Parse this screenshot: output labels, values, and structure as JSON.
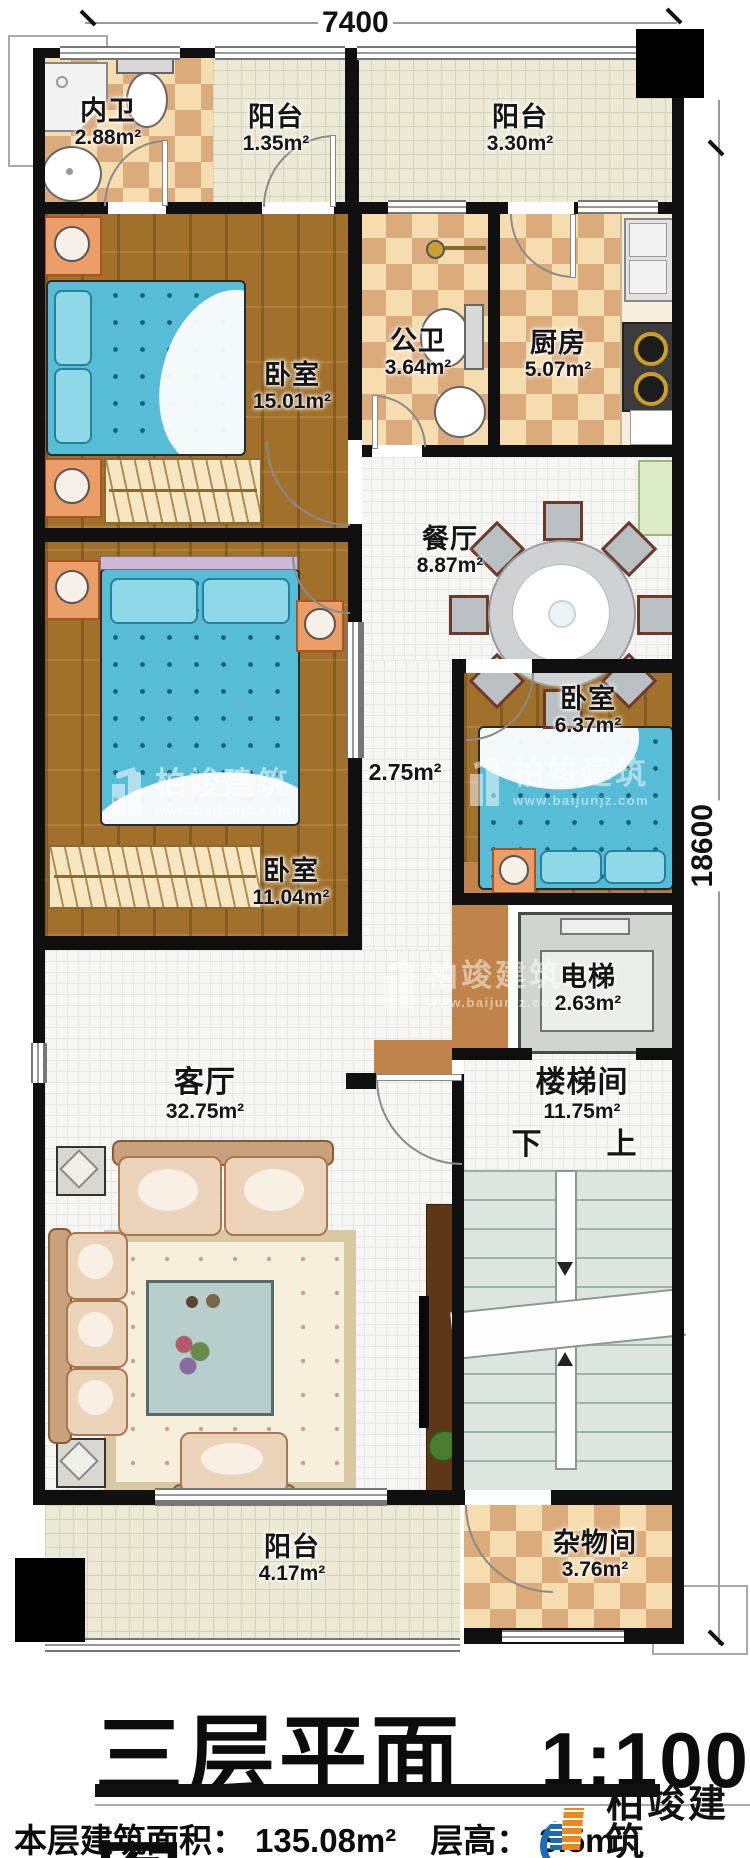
{
  "dimensions": {
    "width_mm": "7400",
    "height_mm": "18600"
  },
  "rooms": {
    "neiwei": {
      "name": "内卫",
      "area": "2.88m²"
    },
    "balcony_nw": {
      "name": "阳台",
      "area": "1.35m²"
    },
    "balcony_ne": {
      "name": "阳台",
      "area": "3.30m²"
    },
    "bedroom_nw": {
      "name": "卧室",
      "area": "15.01m²"
    },
    "gongwei": {
      "name": "公卫",
      "area": "3.64m²"
    },
    "kitchen": {
      "name": "厨房",
      "area": "5.07m²"
    },
    "dining": {
      "name": "餐厅",
      "area": "8.87m²"
    },
    "bedroom_e": {
      "name": "卧室",
      "area": "6.37m²"
    },
    "bedroom_w": {
      "name": "卧室",
      "area": "11.04m²"
    },
    "hall": {
      "area": "2.75m²"
    },
    "elevator": {
      "name": "电梯",
      "area": "2.63m²"
    },
    "living": {
      "name": "客厅",
      "area": "32.75m²"
    },
    "stairwell": {
      "name": "楼梯间",
      "area": "11.75m²"
    },
    "balcony_s": {
      "name": "阳台",
      "area": "4.17m²"
    },
    "storage": {
      "name": "杂物间",
      "area": "3.76m²"
    }
  },
  "stairs": {
    "down": "下",
    "up": "上"
  },
  "title": {
    "text": "三层平面图",
    "scale": "1:100"
  },
  "footer": {
    "area_label": "本层建筑面积：",
    "area_value": "135.08m²",
    "height_label": "层高：",
    "height_value": "3.5m"
  },
  "brand": {
    "name": "柏竣建筑",
    "url": "www.baijunjz.com",
    "icon": "building-logo",
    "color_blue": "#1b6bb5",
    "color_orange": "#f08519"
  },
  "watermark": {
    "name": "柏竣建筑",
    "url": "www.baijunjz.com",
    "icon": "building-logo"
  }
}
